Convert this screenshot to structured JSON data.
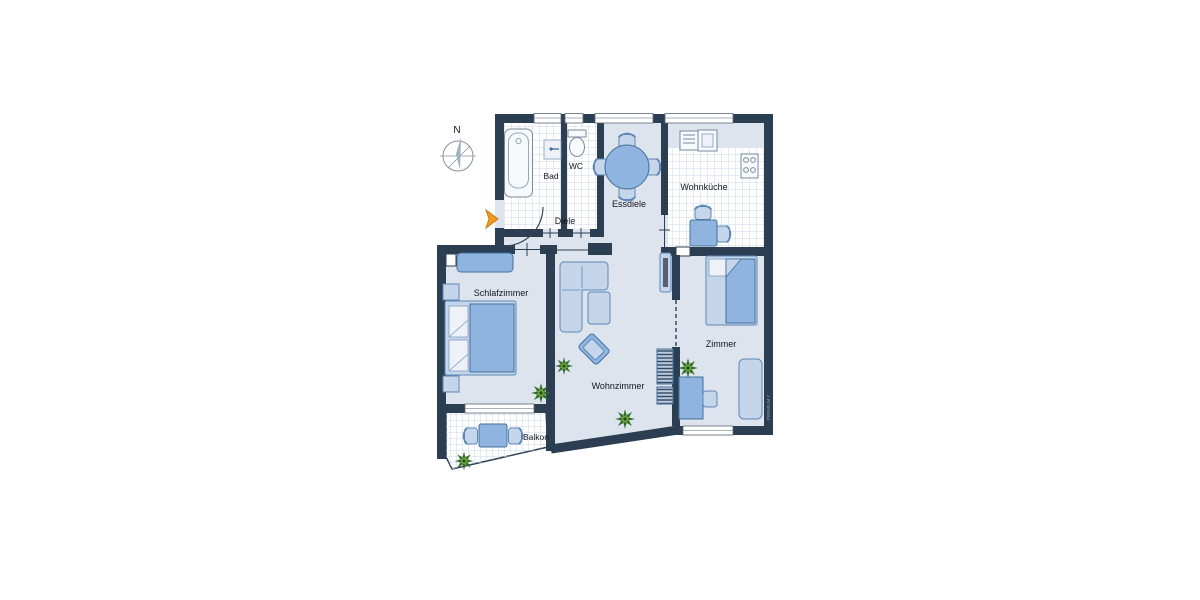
{
  "rooms": {
    "bad": "Bad",
    "wc": "WC",
    "essdiele": "Essdiele",
    "diele": "Diele",
    "wohnkueche": "Wohnküche",
    "schlafzimmer": "Schlafzimmer",
    "wohnzimmer": "Wohnzimmer",
    "zimmer": "Zimmer",
    "balkon": "Balkon"
  },
  "compass": {
    "north_label": "N"
  },
  "watermark": "PREMIUM 7",
  "colors": {
    "wall": "#2c3e52",
    "floor": "#dde4ee",
    "furniture": "#8fb4df",
    "furniture_light": "#c5d6ea",
    "tile": "#ffffff",
    "accent_arrow": "#f49a1c",
    "plant_dark": "#2e6b2f",
    "plant_light": "#79a83d"
  }
}
